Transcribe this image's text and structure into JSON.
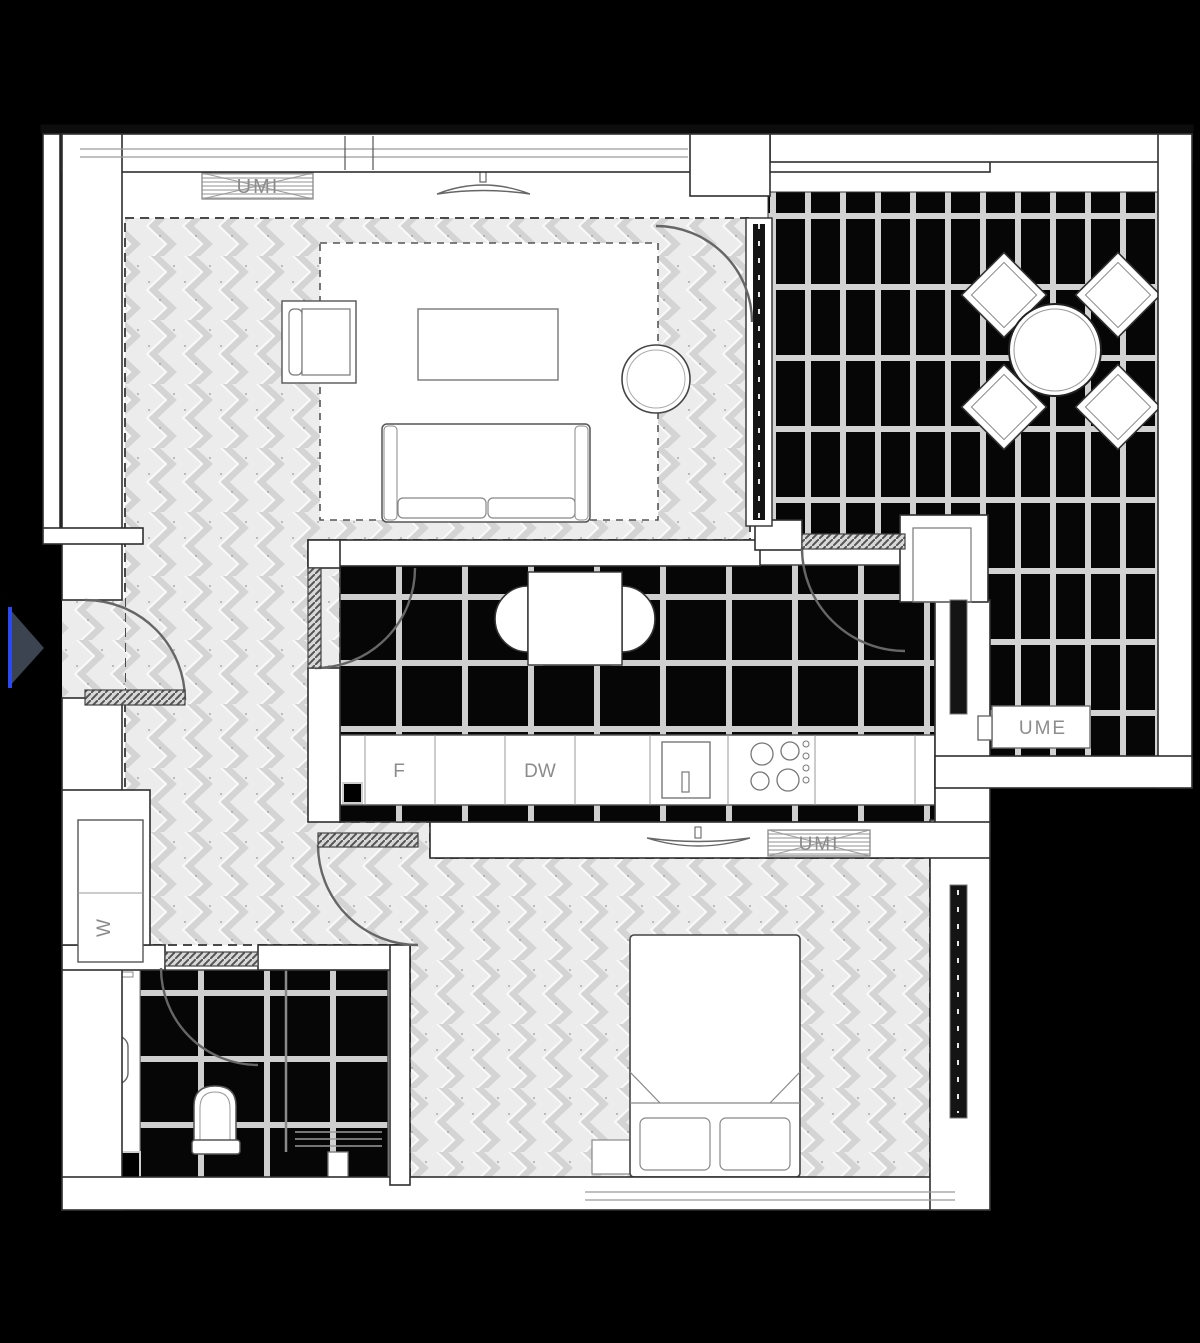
{
  "plan": {
    "labels": {
      "living_ac_unit": "UMI",
      "bedroom_ac_unit": "UMI",
      "balcony_ac_unit": "UME",
      "fridge": "F",
      "dishwasher": "DW",
      "washing_machine": "W"
    },
    "colors": {
      "background": "#000000",
      "wall_fill": "#ffffff",
      "wall_line": "#2e2e2e",
      "parquet_base": "#ececec",
      "parquet_stroke": "#d4d4d4",
      "tile_dark": "#060606",
      "tile_grout": "#d2d2d2",
      "label_text": "#8c8c8c",
      "door_arc": "#666666",
      "entry_marker_fill": "#3b4450",
      "entry_marker_accent": "#2b49f0"
    }
  }
}
